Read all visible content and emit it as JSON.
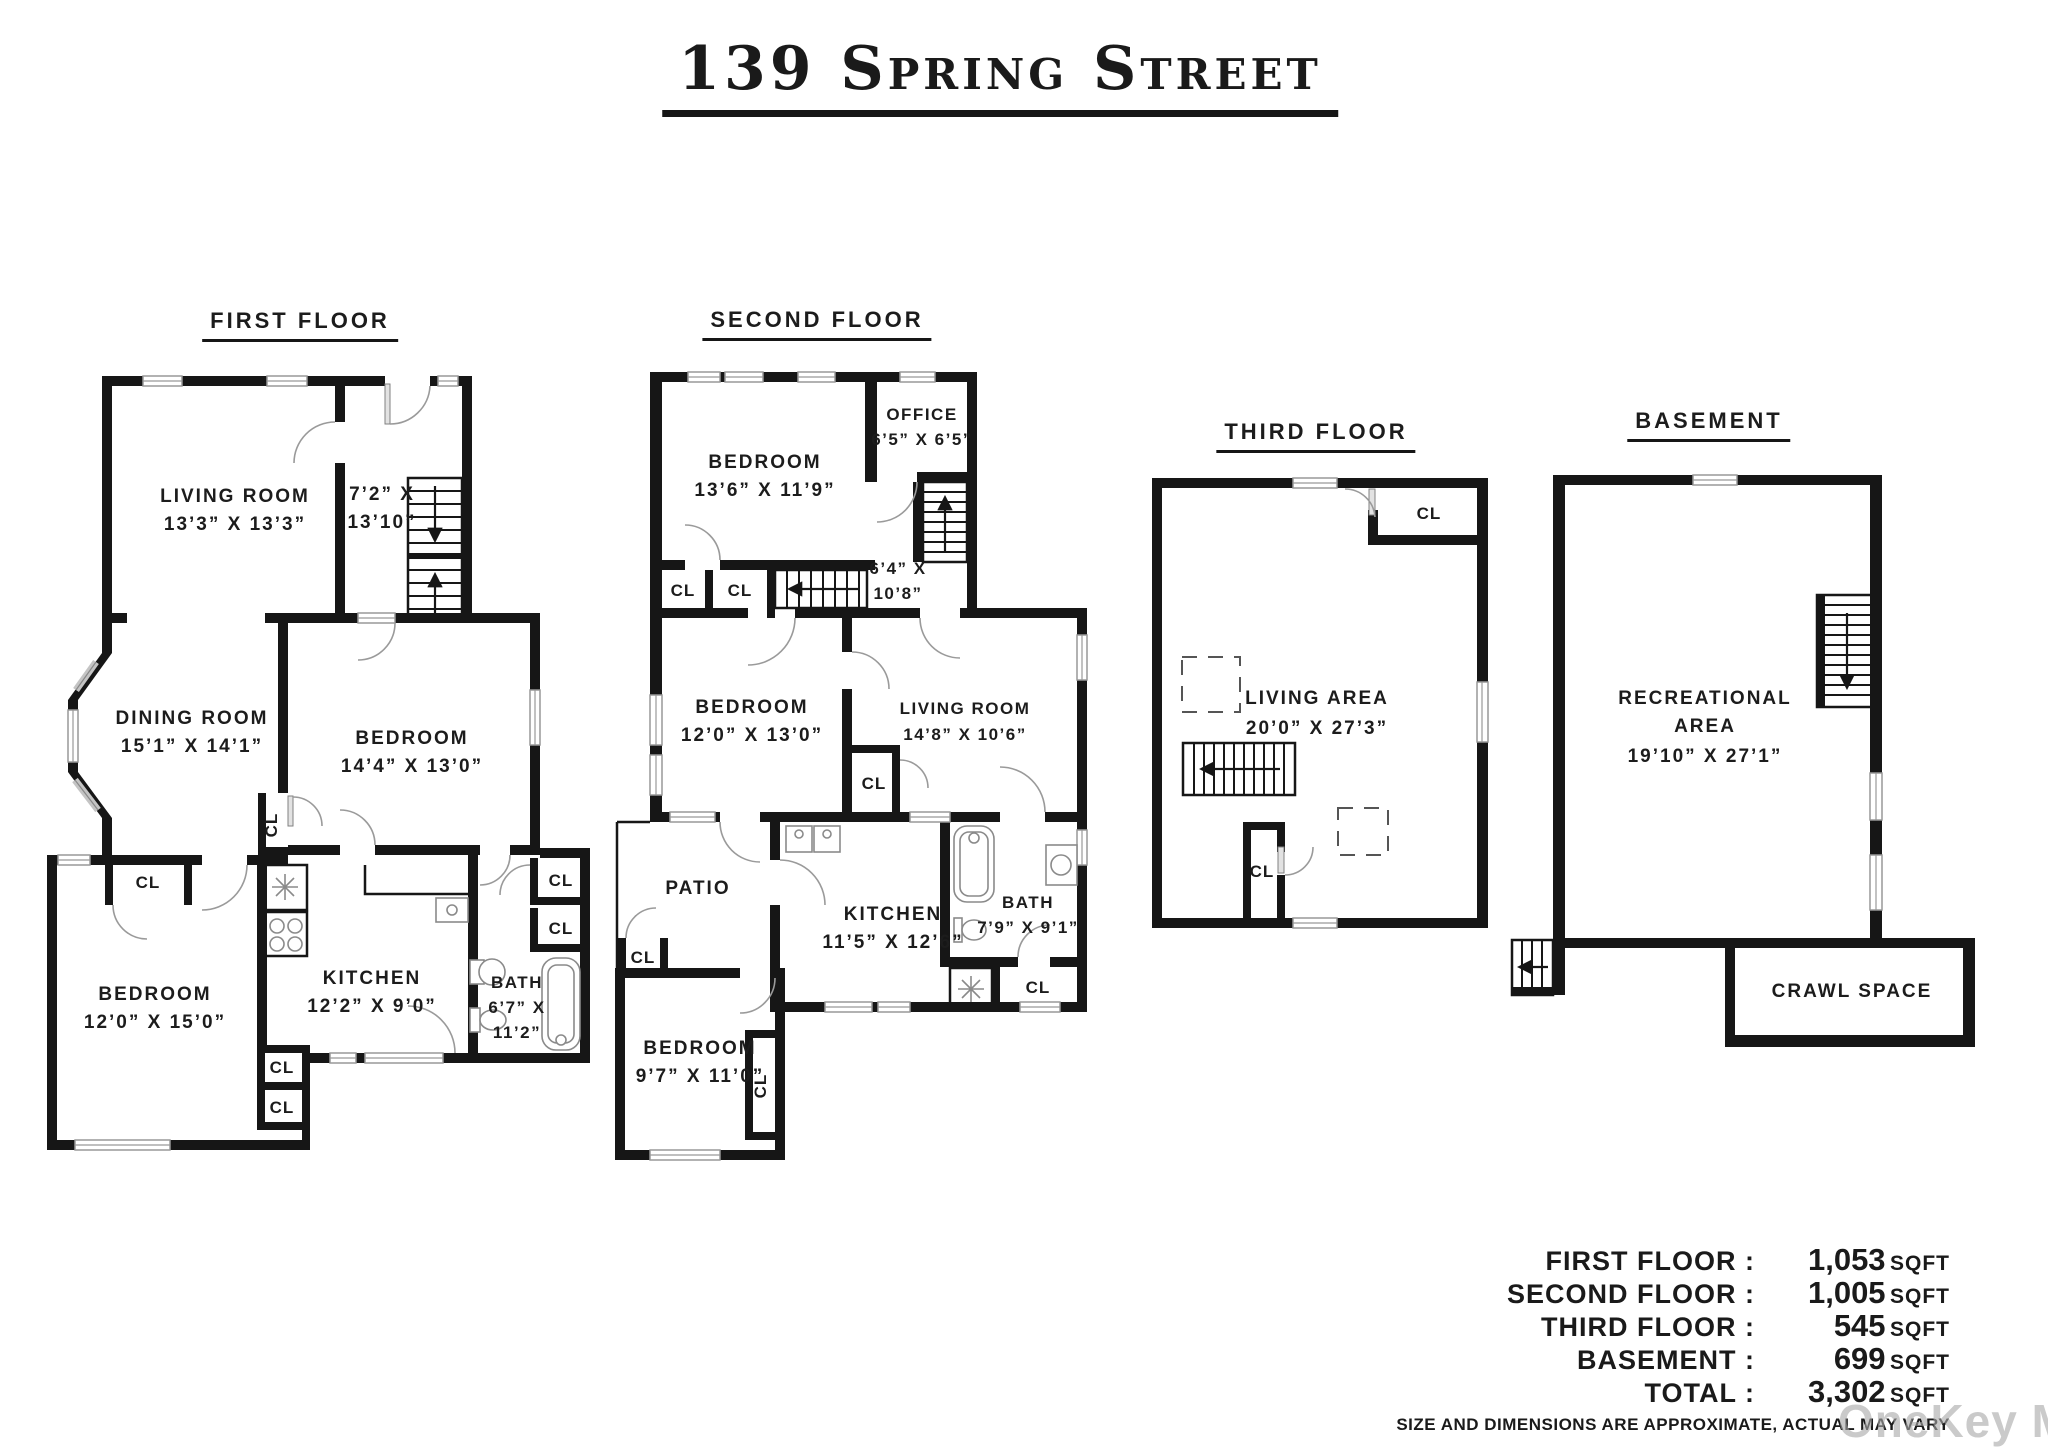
{
  "title": "139 Spring Street",
  "labels": {
    "cl": "CL"
  },
  "floors": {
    "first": {
      "title": "FIRST FLOOR",
      "living_room": [
        "LIVING ROOM",
        "13’3” X 13’3”"
      ],
      "stair_hall": [
        "7’2” X",
        "13’10”"
      ],
      "dining_room": [
        "DINING ROOM",
        "15’1” X 14’1”"
      ],
      "bedroom_right": [
        "BEDROOM",
        "14’4” X 13’0”"
      ],
      "bedroom_left": [
        "BEDROOM",
        "12’0” X 15’0”"
      ],
      "kitchen": [
        "KITCHEN",
        "12’2” X 9’0”"
      ],
      "bath": [
        "BATH",
        "6’7” X",
        "11’2”"
      ]
    },
    "second": {
      "title": "SECOND FLOOR",
      "bedroom_top": [
        "BEDROOM",
        "13’6” X 11’9”"
      ],
      "office": [
        "OFFICE",
        "6’5” X 6’5”"
      ],
      "stair_hall": [
        "6’4” X",
        "10’8”"
      ],
      "bedroom_mid": [
        "BEDROOM",
        "12’0” X 13’0”"
      ],
      "living_room": [
        "LIVING ROOM",
        "14’8” X 10’6”"
      ],
      "patio": "PATIO",
      "kitchen": [
        "KITCHEN",
        "11’5” X 12’6”"
      ],
      "bath": [
        "BATH",
        "7’9” X 9’1”"
      ],
      "bedroom_bottom": [
        "BEDROOM",
        "9’7” X 11’0”"
      ]
    },
    "third": {
      "title": "THIRD FLOOR",
      "living_area": [
        "LIVING AREA",
        "20’0” X 27’3”"
      ]
    },
    "basement": {
      "title": "BASEMENT",
      "recreational": [
        "RECREATIONAL",
        "AREA",
        "19’10” X 27’1”"
      ],
      "crawl_space": "CRAWL SPACE"
    }
  },
  "summary": {
    "rows": [
      {
        "label": "FIRST FLOOR :",
        "value": "1,053",
        "unit": "SQFT"
      },
      {
        "label": "SECOND FLOOR :",
        "value": "1,005",
        "unit": "SQFT"
      },
      {
        "label": "THIRD FLOOR :",
        "value": "545",
        "unit": "SQFT"
      },
      {
        "label": "BASEMENT :",
        "value": "699",
        "unit": "SQFT"
      },
      {
        "label": "TOTAL :",
        "value": "3,302",
        "unit": "SQFT"
      }
    ],
    "disclaimer": "SIZE AND DIMENSIONS ARE APPROXIMATE, ACTUAL MAY VARY"
  },
  "watermark": "OneKey MLS"
}
